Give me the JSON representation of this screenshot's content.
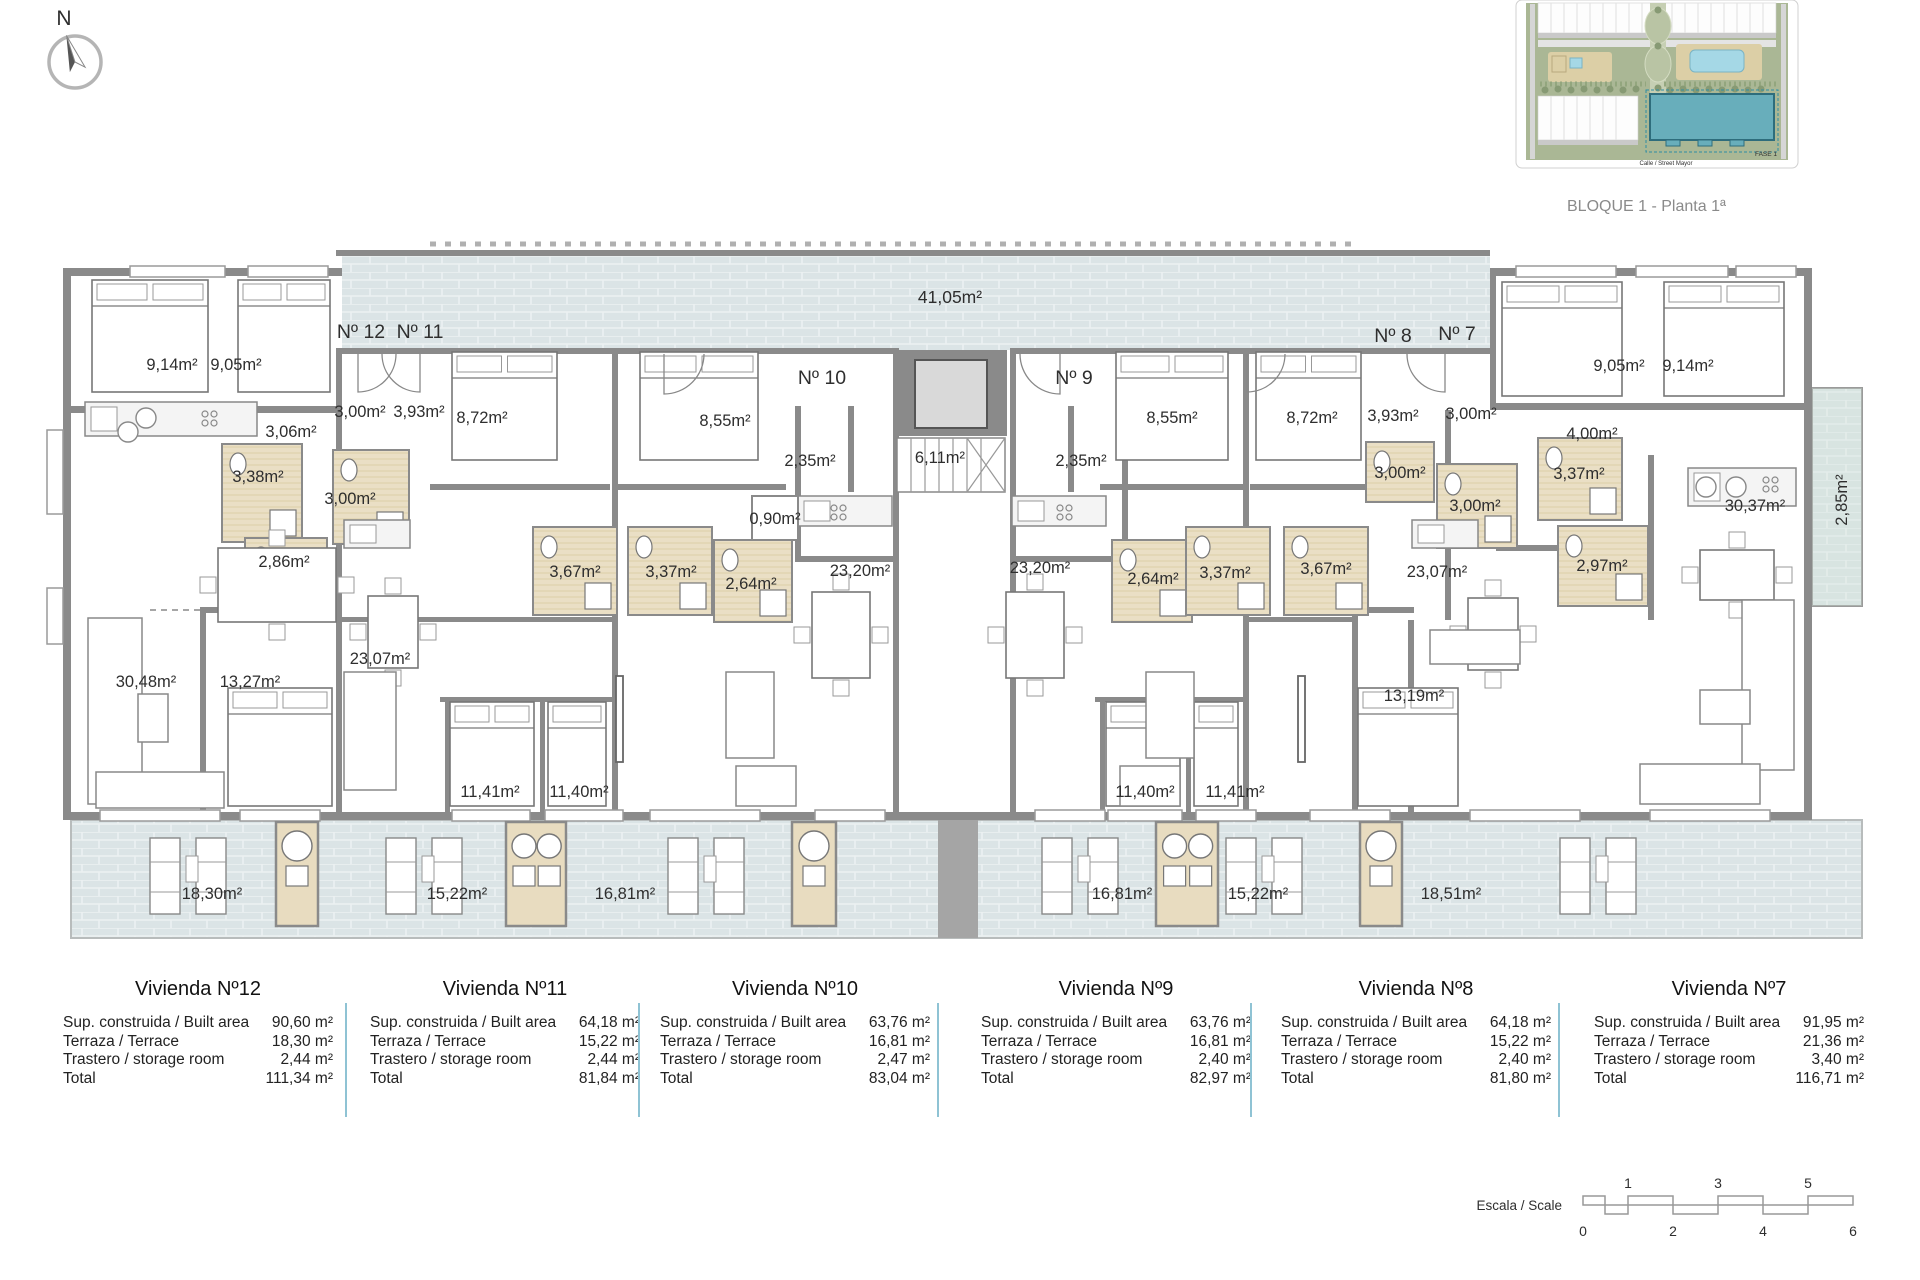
{
  "compass": {
    "label": "N"
  },
  "site_plan": {
    "caption": "BLOQUE 1 - Planta 1ª",
    "street_label": "Calle / Street Mayor",
    "phase_label": "FASE 1",
    "highlight_color": "#68aebb"
  },
  "floor_plan": {
    "wall_color": "#8a8a8a",
    "terrace_tile_color": "#dbe4e6",
    "bathroom_color": "#eadfc5",
    "apartment_labels": [
      {
        "t": "Nº 12",
        "x": 361,
        "y": 331
      },
      {
        "t": "Nº 11",
        "x": 420,
        "y": 331
      },
      {
        "t": "Nº 10",
        "x": 822,
        "y": 377
      },
      {
        "t": "Nº 9",
        "x": 1074,
        "y": 377
      },
      {
        "t": "Nº 8",
        "x": 1393,
        "y": 335
      },
      {
        "t": "Nº 7",
        "x": 1457,
        "y": 333
      }
    ],
    "room_labels": [
      {
        "t": "41,05m²",
        "x": 950,
        "y": 297,
        "big": true
      },
      {
        "t": "9,14m²",
        "x": 172,
        "y": 364
      },
      {
        "t": "9,05m²",
        "x": 236,
        "y": 364
      },
      {
        "t": "3,00m²",
        "x": 360,
        "y": 411
      },
      {
        "t": "3,93m²",
        "x": 419,
        "y": 411
      },
      {
        "t": "8,72m²",
        "x": 482,
        "y": 417
      },
      {
        "t": "8,55m²",
        "x": 725,
        "y": 420
      },
      {
        "t": "3,06m²",
        "x": 291,
        "y": 431
      },
      {
        "t": "2,35m²",
        "x": 810,
        "y": 460
      },
      {
        "t": "6,11m²",
        "x": 940,
        "y": 457
      },
      {
        "t": "0,90m²",
        "x": 775,
        "y": 518
      },
      {
        "t": "3,38m²",
        "x": 258,
        "y": 476
      },
      {
        "t": "3,00m²",
        "x": 350,
        "y": 498
      },
      {
        "t": "2,86m²",
        "x": 284,
        "y": 561
      },
      {
        "t": "3,67m²",
        "x": 575,
        "y": 571
      },
      {
        "t": "3,37m²",
        "x": 671,
        "y": 571
      },
      {
        "t": "2,64m²",
        "x": 751,
        "y": 583
      },
      {
        "t": "23,20m²",
        "x": 860,
        "y": 570
      },
      {
        "t": "23,07m²",
        "x": 380,
        "y": 658
      },
      {
        "t": "30,48m²",
        "x": 146,
        "y": 681
      },
      {
        "t": "13,27m²",
        "x": 250,
        "y": 681
      },
      {
        "t": "11,41m²",
        "x": 490,
        "y": 791
      },
      {
        "t": "11,40m²",
        "x": 579,
        "y": 791
      },
      {
        "t": "18,30m²",
        "x": 212,
        "y": 893
      },
      {
        "t": "15,22m²",
        "x": 457,
        "y": 893
      },
      {
        "t": "16,81m²",
        "x": 625,
        "y": 893
      },
      {
        "t": "8,55m²",
        "x": 1172,
        "y": 417
      },
      {
        "t": "8,72m²",
        "x": 1312,
        "y": 417
      },
      {
        "t": "3,93m²",
        "x": 1393,
        "y": 415
      },
      {
        "t": "2,35m²",
        "x": 1081,
        "y": 460
      },
      {
        "t": "23,20m²",
        "x": 1040,
        "y": 567
      },
      {
        "t": "2,64m²",
        "x": 1153,
        "y": 578
      },
      {
        "t": "3,37m²",
        "x": 1225,
        "y": 572
      },
      {
        "t": "3,67m²",
        "x": 1326,
        "y": 568
      },
      {
        "t": "3,00m²",
        "x": 1400,
        "y": 472
      },
      {
        "t": "23,07m²",
        "x": 1437,
        "y": 571
      },
      {
        "t": "9,05m²",
        "x": 1619,
        "y": 365
      },
      {
        "t": "9,14m²",
        "x": 1688,
        "y": 365
      },
      {
        "t": "3,00m²",
        "x": 1471,
        "y": 413
      },
      {
        "t": "4,00m²",
        "x": 1592,
        "y": 433
      },
      {
        "t": "3,37m²",
        "x": 1579,
        "y": 473
      },
      {
        "t": "3,00m²",
        "x": 1475,
        "y": 505
      },
      {
        "t": "2,97m²",
        "x": 1602,
        "y": 565
      },
      {
        "t": "30,37m²",
        "x": 1755,
        "y": 505
      },
      {
        "t": "2,85m²",
        "x": 1841,
        "y": 500,
        "rot": -90
      },
      {
        "t": "13,19m²",
        "x": 1414,
        "y": 695
      },
      {
        "t": "11,40m²",
        "x": 1145,
        "y": 791
      },
      {
        "t": "11,41m²",
        "x": 1235,
        "y": 791
      },
      {
        "t": "16,81m²",
        "x": 1122,
        "y": 893
      },
      {
        "t": "15,22m²",
        "x": 1258,
        "y": 893
      },
      {
        "t": "18,51m²",
        "x": 1451,
        "y": 893
      }
    ]
  },
  "area_tables": {
    "row_labels": [
      "Sup. construida / Built area",
      "Terraza / Terrace",
      "Trastero / storage room",
      "Total"
    ],
    "divider_color": "#8fc3d4",
    "columns": [
      {
        "title": "Vivienda Nº12",
        "values": [
          "90,60 m²",
          "18,30 m²",
          "2,44 m²",
          "111,34 m²"
        ]
      },
      {
        "title": "Vivienda Nº11",
        "values": [
          "64,18 m²",
          "15,22 m²",
          "2,44 m²",
          "81,84 m²"
        ]
      },
      {
        "title": "Vivienda Nº10",
        "values": [
          "63,76 m²",
          "16,81 m²",
          "2,47 m²",
          "83,04 m²"
        ]
      },
      {
        "title": "Vivienda Nº9",
        "values": [
          "63,76 m²",
          "16,81 m²",
          "2,40 m²",
          "82,97 m²"
        ]
      },
      {
        "title": "Vivienda Nº8",
        "values": [
          "64,18 m²",
          "15,22 m²",
          "2,40 m²",
          "81,80 m²"
        ]
      },
      {
        "title": "Vivienda Nº7",
        "values": [
          "91,95 m²",
          "21,36 m²",
          "3,40 m²",
          "116,71 m²"
        ]
      }
    ]
  },
  "scale_bar": {
    "label": "Escala / Scale",
    "top_numbers": [
      {
        "t": "1",
        "u": 1
      },
      {
        "t": "3",
        "u": 3
      },
      {
        "t": "5",
        "u": 5
      }
    ],
    "bottom_numbers": [
      {
        "t": "0",
        "u": 0
      },
      {
        "t": "2",
        "u": 2
      },
      {
        "t": "4",
        "u": 4
      },
      {
        "t": "6",
        "u": 6
      }
    ]
  }
}
